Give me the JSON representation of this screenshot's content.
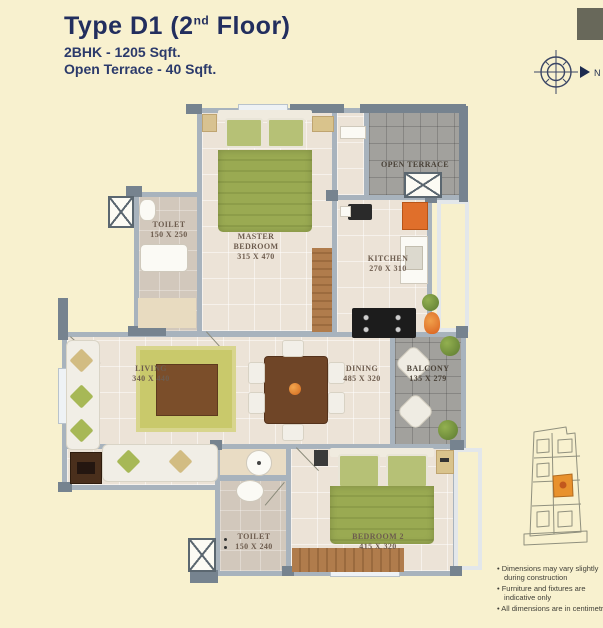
{
  "header": {
    "title_pre": "Type D1 (2",
    "title_sup": "nd",
    "title_post": " Floor)",
    "subtitle1": "2BHK - 1205 Sqft.",
    "subtitle2": "Open Terrace - 40 Sqft."
  },
  "compass": {
    "label": "N"
  },
  "rooms": {
    "toilet1": {
      "name": "TOILET",
      "dims": "150 X 250"
    },
    "master_bedroom": {
      "name": "MASTER BEDROOM",
      "dims": "315 X 470"
    },
    "open_terrace": {
      "name": "OPEN TERRACE"
    },
    "kitchen": {
      "name": "KITCHEN",
      "dims": "270 X 310"
    },
    "living": {
      "name": "LIVING",
      "dims": "340 X 440"
    },
    "dining": {
      "name": "DINING",
      "dims": "485 X 320"
    },
    "balcony": {
      "name": "BALCONY",
      "dims": "135 X 279"
    },
    "toilet2": {
      "name": "TOILET",
      "dims": "150 X 240"
    },
    "bedroom2": {
      "name": "BEDROOM 2",
      "dims": "415 X 320"
    }
  },
  "notes": {
    "items": [
      "Dimensions may vary slightly during  construction",
      "Furniture and fixtures are indicative only",
      "All dimensions are in centimetres"
    ]
  },
  "palette": {
    "page_bg": "#f8f1cf",
    "title_navy": "#222e5e",
    "wall_gray": "#a8b3bd",
    "wall_dark": "#76838f",
    "floor_beige": "#ece3d7",
    "terrace_gray": "#a2a19d",
    "furniture_green": "#9aaa52",
    "wood_brown": "#b07c4c",
    "accent_orange": "#e06f2b",
    "keyplan_highlight": "#e8912d"
  }
}
